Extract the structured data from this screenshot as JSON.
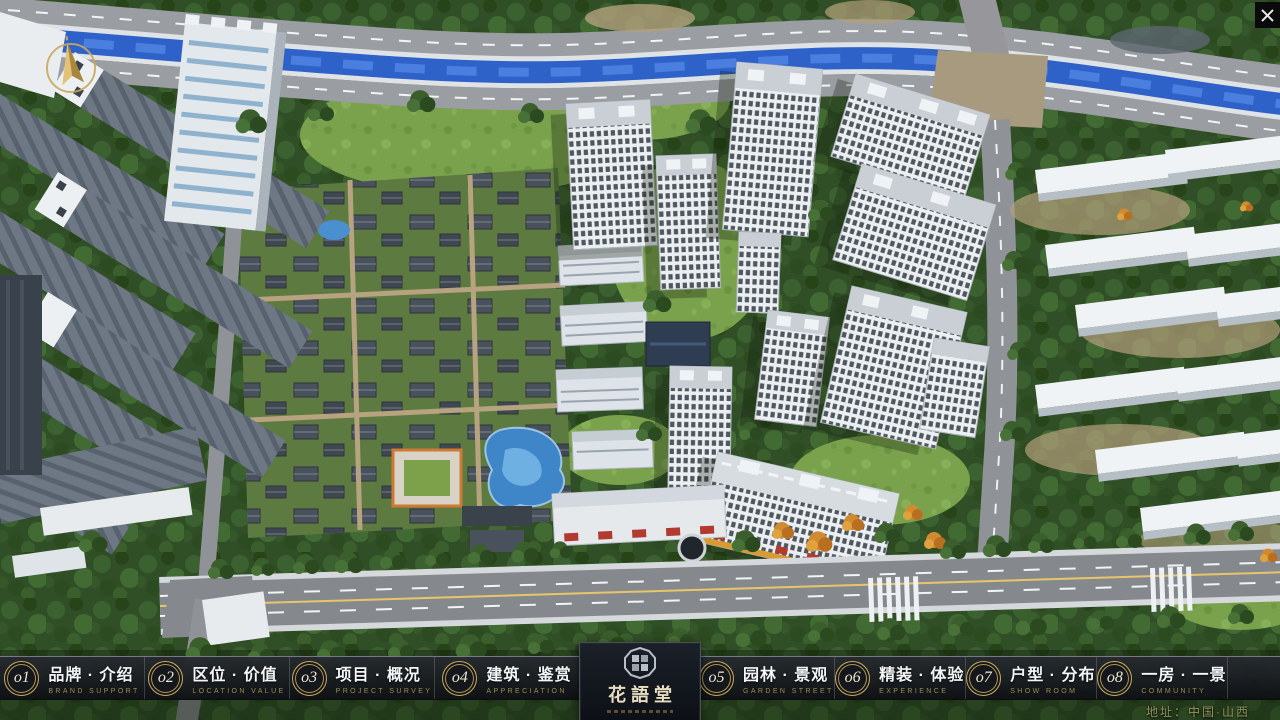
{
  "window": {
    "close_icon": "✕"
  },
  "logo": {
    "title": "花語堂"
  },
  "nav": {
    "items": [
      {
        "num": "o1",
        "zh": "品牌 · 介绍",
        "en": "BRAND SUPPORT"
      },
      {
        "num": "o2",
        "zh": "区位 · 价值",
        "en": "LOCATION VALUE"
      },
      {
        "num": "o3",
        "zh": "项目 · 概况",
        "en": "PROJECT SURVEY"
      },
      {
        "num": "o4",
        "zh": "建筑 · 鉴赏",
        "en": "APPRECIATION"
      },
      {
        "num": "o5",
        "zh": "园林 · 景观",
        "en": "GARDEN STREET"
      },
      {
        "num": "o6",
        "zh": "精装 · 体验",
        "en": "EXPERIENCE"
      },
      {
        "num": "o7",
        "zh": "户型 · 分布",
        "en": "SHOW ROOM"
      },
      {
        "num": "o8",
        "zh": "一房 · 一景",
        "en": "COMMUNITY"
      }
    ]
  },
  "footer": {
    "address": "地址：中国·山西"
  },
  "colors": {
    "gold": "#c9a961",
    "bar_bg": "#14171c",
    "river": "#2f62c8",
    "tree_green": "#355a2a",
    "road_gray": "#85898d",
    "tower_white": "#eceff2"
  }
}
